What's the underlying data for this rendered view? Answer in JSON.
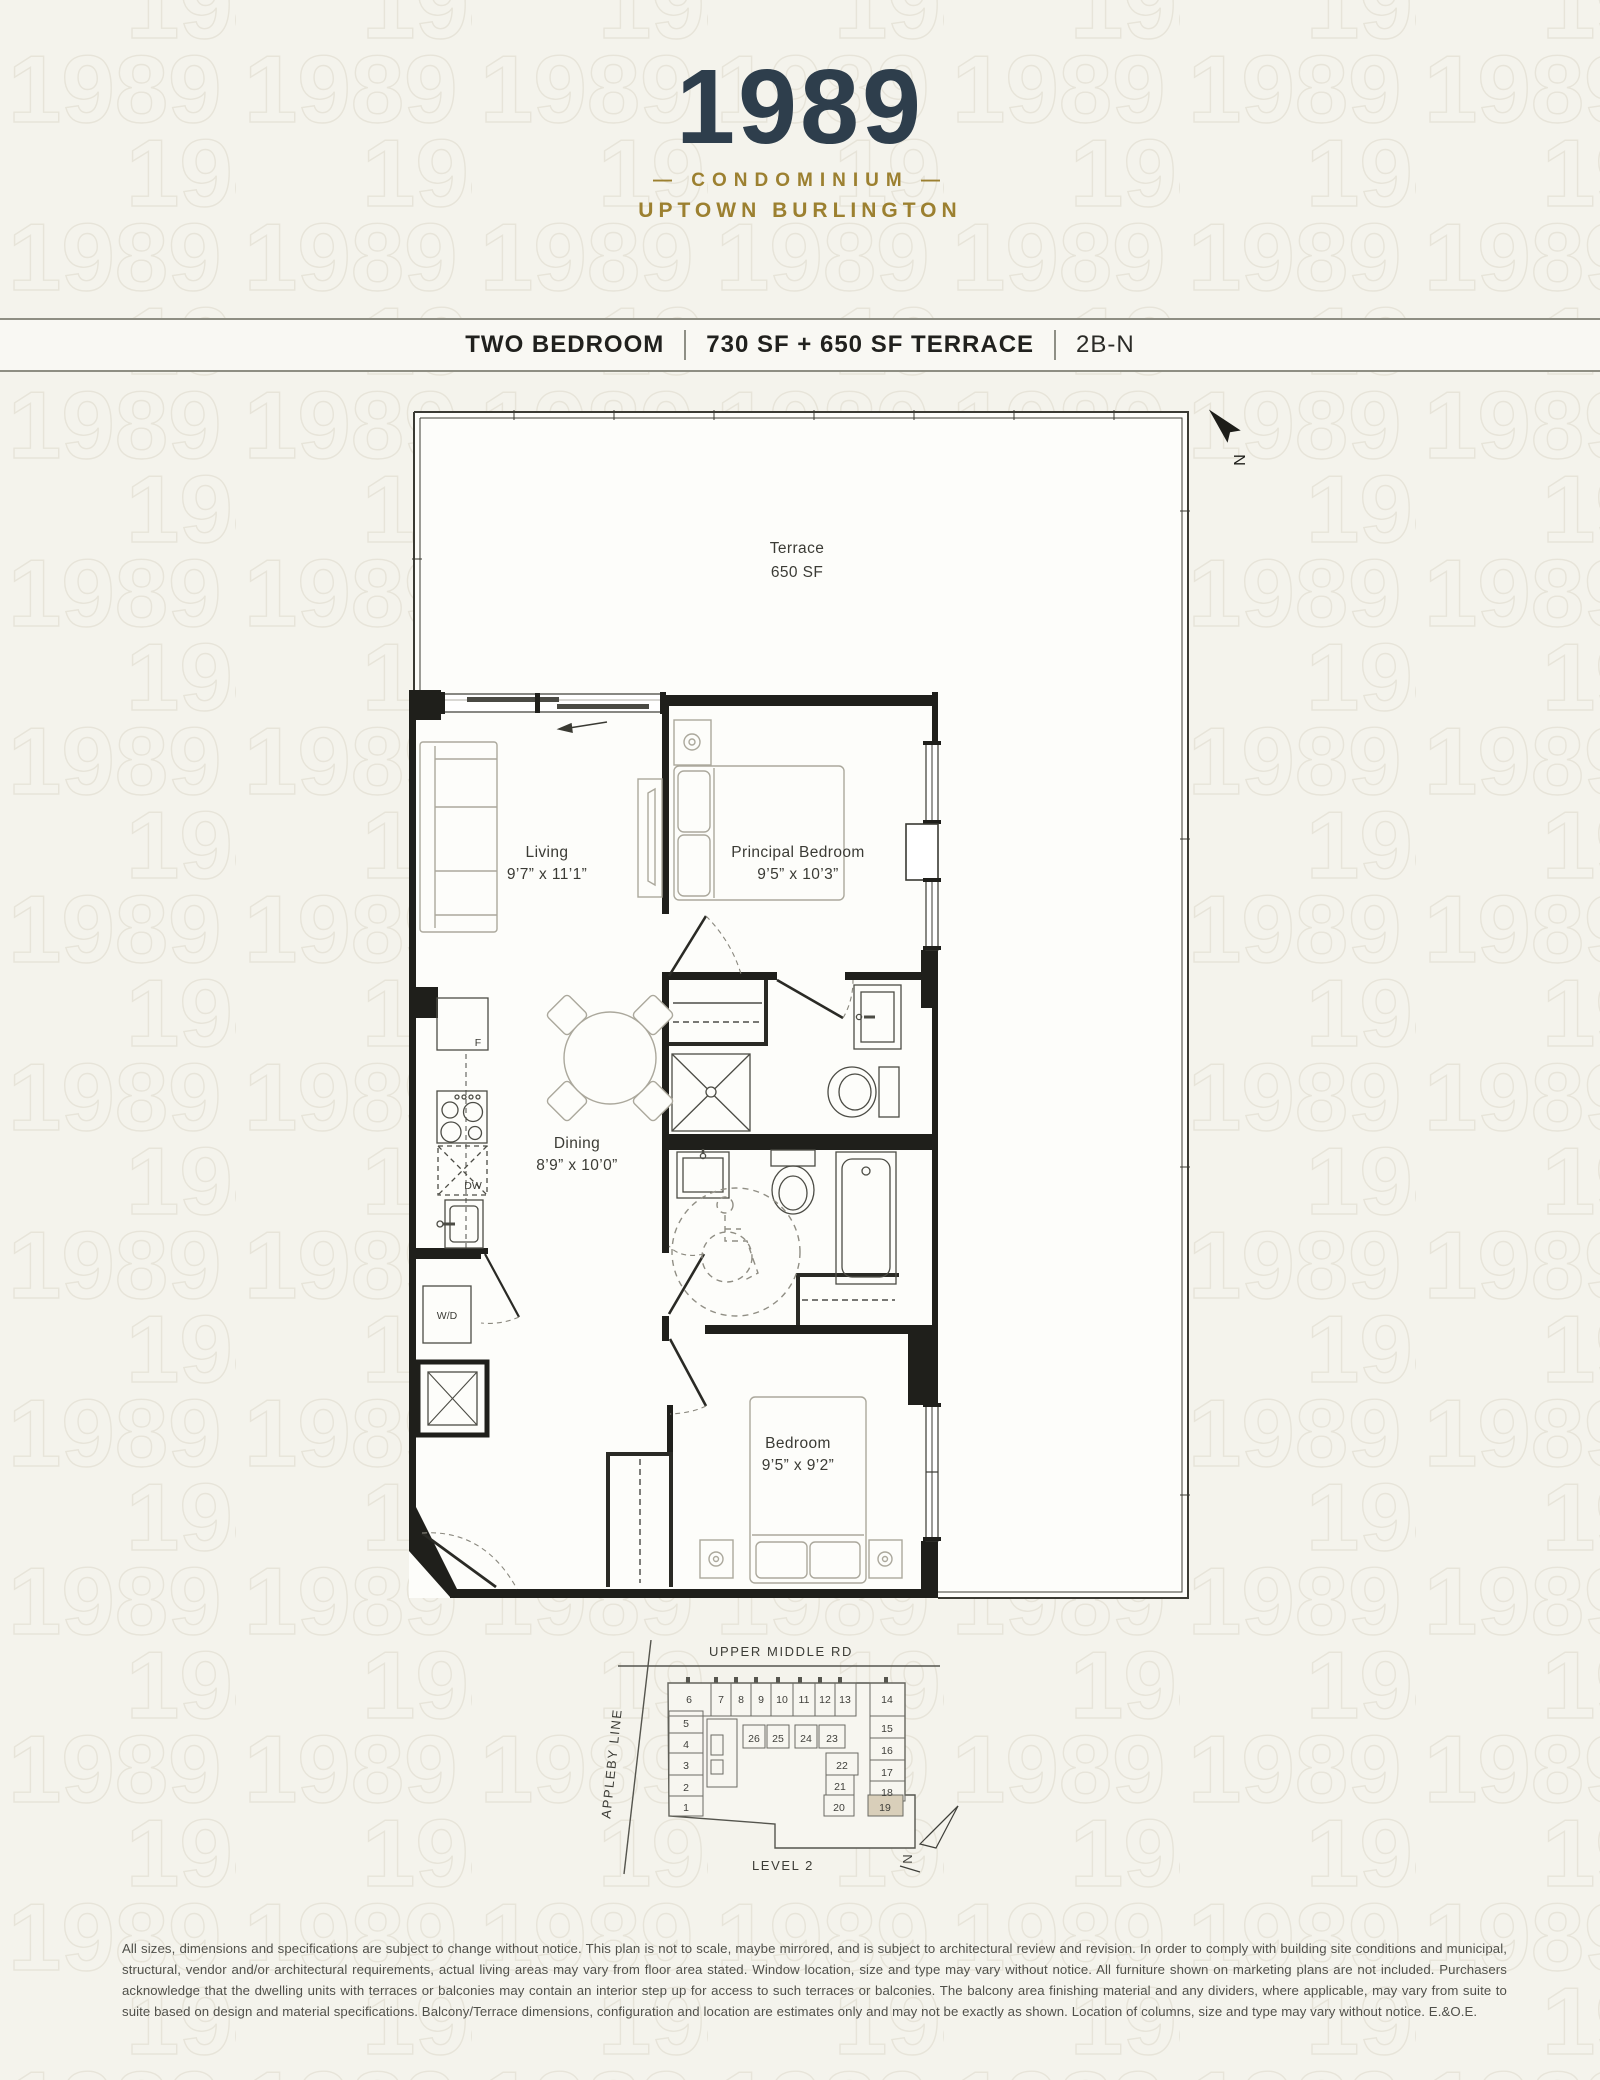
{
  "header": {
    "year": "1989",
    "sub1": "— CONDOMINIUM —",
    "sub2": "UPTOWN BURLINGTON"
  },
  "titlebar": {
    "plan_type": "TWO BEDROOM",
    "area": "730 SF + 650 SF TERRACE",
    "unit_code": "2B-N"
  },
  "floorplan": {
    "terrace": {
      "name": "Terrace",
      "area": "650 SF"
    },
    "rooms": {
      "living": {
        "name": "Living",
        "dims": "9’7” x 11’1”"
      },
      "principal_bedroom": {
        "name": "Principal Bedroom",
        "dims": "9’5” x 10’3”"
      },
      "dining": {
        "name": "Dining",
        "dims": "8’9” x 10’0”"
      },
      "bedroom": {
        "name": "Bedroom",
        "dims": "9’5” x 9’2”"
      }
    },
    "appliances": {
      "fridge": "F",
      "dishwasher": "DW",
      "washer_dryer": "W/D"
    },
    "north_label": "N"
  },
  "keyplan": {
    "road_top": "UPPER MIDDLE RD",
    "road_left": "APPLEBY LINE",
    "level": "LEVEL 2",
    "north_label": "N",
    "highlighted_unit": "19",
    "units": {
      "u1": "1",
      "u2": "2",
      "u3": "3",
      "u4": "4",
      "u5": "5",
      "u6": "6",
      "u7": "7",
      "u8": "8",
      "u9": "9",
      "u10": "10",
      "u11": "11",
      "u12": "12",
      "u13": "13",
      "u14": "14",
      "u15": "15",
      "u16": "16",
      "u17": "17",
      "u18": "18",
      "u19": "19",
      "u20": "20",
      "u21": "21",
      "u22": "22",
      "u23": "23",
      "u24": "24",
      "u25": "25",
      "u26": "26"
    }
  },
  "disclaimer": "All sizes, dimensions and specifications are subject to change without notice. This plan is not to scale, maybe mirrored, and is subject to architectural review and revision. In order to comply with building site conditions and municipal, structural, vendor and/or architectural requirements, actual living areas may vary from floor area stated. Window location, size and type may vary without notice. All furniture shown on marketing plans are not included. Purchasers acknowledge that the dwelling units with terraces or balconies may contain an interior step up for access to such terraces or balconies. The balcony area finishing material and any dividers, where applicable, may vary from suite to suite based on design and material specifications. Balcony/Terrace dimensions, configuration and location are estimates only and may not be exactly as shown. Location of columns, size and type may vary without notice. E.&O.E.",
  "colors": {
    "background": "#f4f3ec",
    "pattern_line": "#e7e4d9",
    "logo_navy": "#2e3e4c",
    "logo_gold": "#9c8030",
    "wall": "#1f1f1b",
    "fixture_line": "#4c4c45",
    "furniture_line": "#aba89c",
    "keyplan_highlight": "#d9cfba"
  }
}
